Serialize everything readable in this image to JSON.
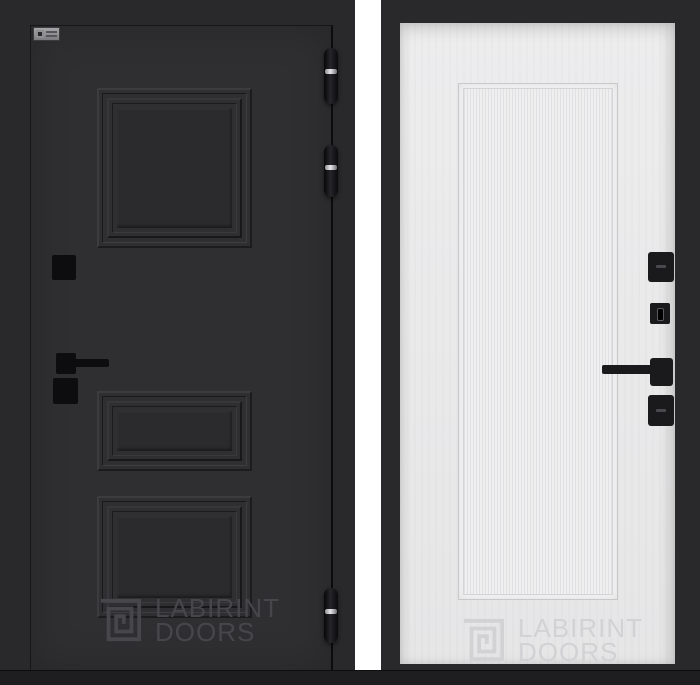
{
  "brand": {
    "watermark": {
      "line1": "LABIRINT",
      "line2": "DOORS"
    },
    "logo_icon": "labirint-maze-icon",
    "logo_plate_color": "#909093"
  },
  "left_door": {
    "description": "dark graphite door leaf, front side",
    "face_color": "#2f2f31",
    "frame_color": "#29292b",
    "molding_panel_count": 3,
    "hinge_count": 3,
    "hinge_color": "#131316",
    "hinge_ring_color": "#c9c9cc",
    "hardware_color": "#0d0d0f",
    "hardware_items": [
      "square-escutcheon-top",
      "lever-handle",
      "square-escutcheon-bottom"
    ],
    "watermark_color": "#47474b"
  },
  "right_door": {
    "description": "white ribbed door leaf, back side",
    "face_color": "#e9e9ea",
    "edge_color": "#29292b",
    "rib_stripe_light": "#efeff0",
    "rib_stripe_dark": "#e0e0e2",
    "hardware_color": "#1a1a1c",
    "hardware_items": [
      "thumbturn-plate",
      "keyhole-plate",
      "lever-handle",
      "lock-plate"
    ],
    "watermark_color": "#d2d2d5"
  }
}
